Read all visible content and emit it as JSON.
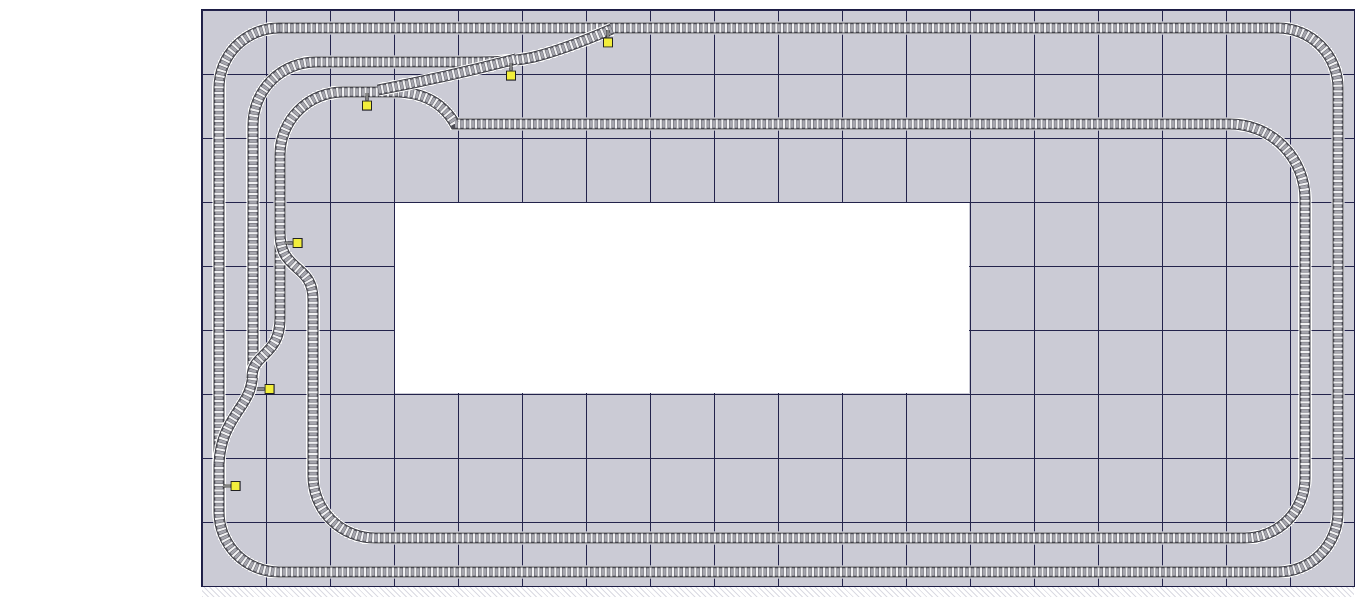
{
  "plan": {
    "description": "model-railroad-track-plan-on-gridded-baseboard",
    "board": {
      "columns": 18,
      "rows": 9,
      "cell_px": 64,
      "x": 202,
      "y": 10,
      "width": 1152,
      "height": 576
    },
    "cutout": {
      "x": 395,
      "y": 203,
      "width": 574,
      "height": 190
    }
  },
  "colors": {
    "background": "#ffffff",
    "dot": "#2e2e56",
    "grid_line": "#23234b",
    "border": "#1d1d45",
    "track_halo": "#ffffff",
    "rail_edge": "#383840",
    "track_bed": "#f2f2f4",
    "tie_dark": "#4c4c54",
    "tie_light": "#a6a6ae",
    "marker_fill": "#f2ee3c",
    "marker_border": "#222222"
  },
  "track_style": {
    "layers": [
      {
        "width": 13,
        "color": "#ffffff"
      },
      {
        "width": 11,
        "color": "#383840"
      },
      {
        "width": 9,
        "color": "#f2f2f4"
      },
      {
        "width": 9,
        "color": "#4c4c54",
        "dash": "3.4 2.2"
      },
      {
        "width": 7.4,
        "color": "#a6a6ae",
        "dash": "2.6 3",
        "offset": -0.4
      }
    ]
  },
  "tracks": [
    {
      "id": "outer-loop",
      "path": "M 279 28 H 1278 A 60 60 0 0 1 1338 88 V 512 A 60 60 0 0 1 1278 572 H 279 A 60 60 0 0 1 219 512 V 88 A 60 60 0 0 1 279 28 Z"
    },
    {
      "id": "passing-siding-west",
      "path": "M 612 29 C 584 41 558 51 534 57 C 516 61 500 62 478 62 L 316 62 A 63 63 0 0 0 253 125 L 253 368 C 253 390 246 399 238 411 C 228 426 220 440 219 464"
    },
    {
      "id": "yard-track-connector",
      "path": "M 280 232 L 280 318 C 280 339 272 347 264 355 C 257 362 252 366 252 378"
    },
    {
      "id": "inner-loop",
      "path": "M 398 92 H 343 A 63 63 0 0 0 280 155 L 280 232 C 280 252 287 259 296 267 C 305 275 313 281 313 300 L 313 476 A 62 62 0 0 0 375 538 H 1245 A 60 60 0 0 0 1305 478 V 199 A 75 75 0 0 0 1230 124 H 455 C 443 103 424 93 398 92 Z"
    },
    {
      "id": "yard-ladder-diagonal",
      "path": "M 378 90 C 420 82 470 71 516 59"
    }
  ],
  "markers": [
    {
      "id": "switch-stand-top-main",
      "transform": "translate(608,30)"
    },
    {
      "id": "switch-stand-siding-join",
      "transform": "translate(511,63)"
    },
    {
      "id": "switch-stand-yard-throat",
      "transform": "translate(367,93)"
    },
    {
      "id": "switch-stand-left-upper",
      "transform": "translate(285,243) rotate(-90)"
    },
    {
      "id": "switch-stand-left-middle",
      "transform": "translate(257,389) rotate(-90)"
    },
    {
      "id": "switch-stand-left-lower",
      "transform": "translate(223,486) rotate(-90)"
    }
  ]
}
